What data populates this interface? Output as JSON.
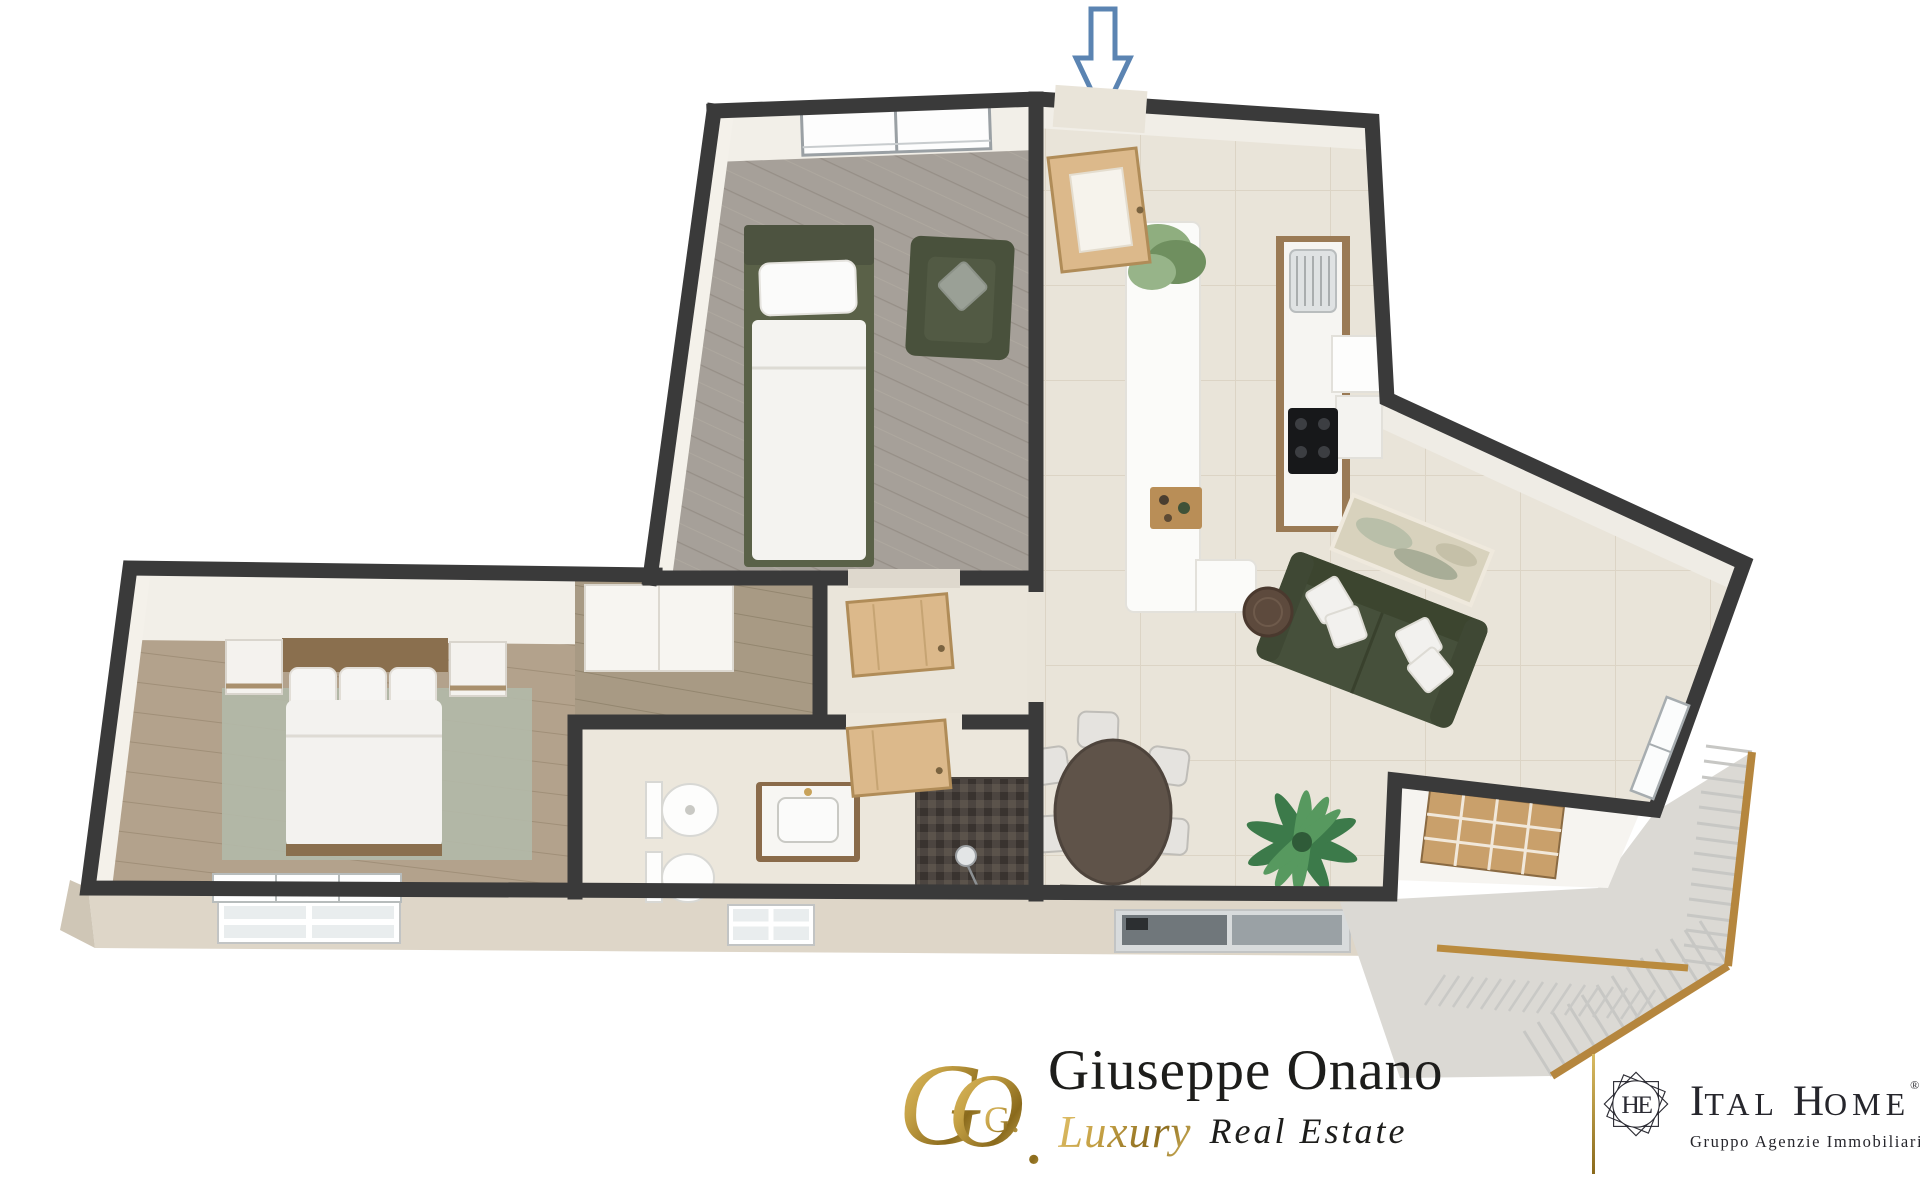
{
  "entrance_arrow": {
    "meaning": "entrance indicator",
    "direction": "down",
    "stroke_color": "#5b84b2",
    "fill_color": "#ffffff"
  },
  "palette": {
    "wall": "#3a3a3a",
    "tile_floor": "#e9e4d9",
    "gray_wood_floor": "#a6a099",
    "master_wood_floor": "#b3a28c",
    "hall_wood_floor": "#a89a84",
    "rug": "#b2b9a8",
    "olive_furniture": "#49513c",
    "terrace_floor": "#dbd9d4",
    "facade": "#ded6c8",
    "door_wood": "#dcb98b",
    "railing_wood": "#b5863e",
    "white_furniture": "#f6f5f2"
  },
  "branding": {
    "agent": {
      "monogram": {
        "letter_g": "G",
        "letter_o": "O",
        "inner": "G.",
        "period": "."
      },
      "name": "Giuseppe Onano",
      "tagline_script": "Luxury",
      "tagline_serif": "Real Estate",
      "gold_start": "#d9bb63",
      "gold_end": "#8a6a1c",
      "text_color": "#1d1d1b"
    },
    "agency": {
      "emblem_monogram": "HE",
      "name_initial_1": "I",
      "name_rest_1": "TAL",
      "name_initial_2": "H",
      "name_rest_2": "OME",
      "registered_mark": "®",
      "subtitle": "Gruppo Agenzie Immobiliari",
      "text_color": "#26262c"
    },
    "divider_color": "#b99745"
  }
}
